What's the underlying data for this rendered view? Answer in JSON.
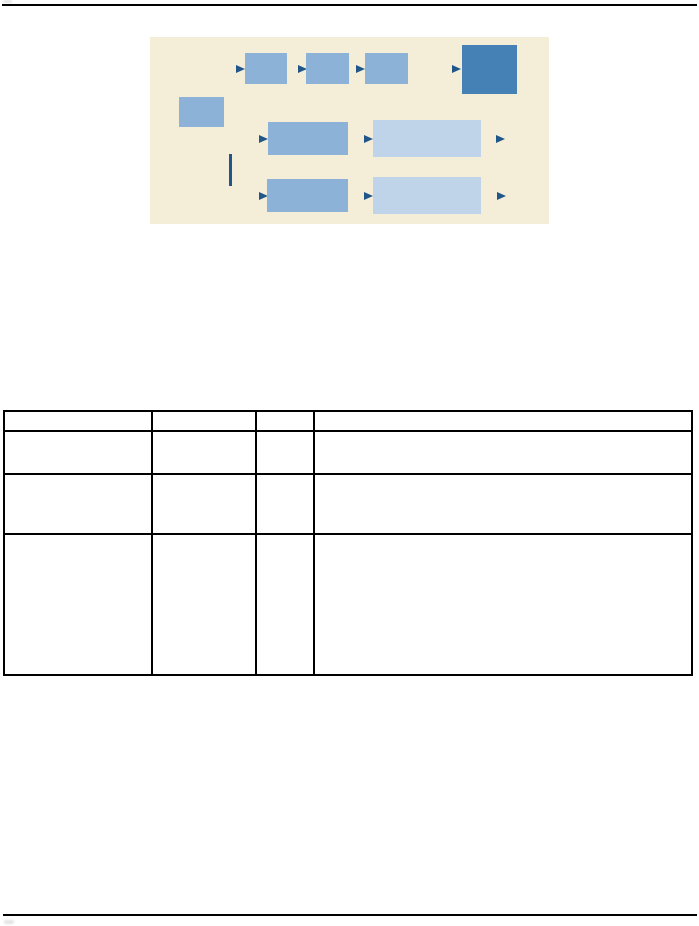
{
  "page": {
    "background": "#ffffff",
    "rule_color": "#000000"
  },
  "figure": {
    "background": "#f4eed8",
    "colors": {
      "node": "#8cb2d8",
      "node_dark": "#4681b5",
      "node_light": "#bfd3e9",
      "connector": "#20568a"
    },
    "nodes": [
      {
        "name": "flow-arrow-1",
        "type": "arrow",
        "x": 86,
        "y": 28
      },
      {
        "name": "flow-box-step1",
        "type": "box",
        "x": 95,
        "y": 16,
        "w": 42,
        "h": 31
      },
      {
        "name": "flow-arrow-2",
        "type": "arrow",
        "x": 148,
        "y": 28
      },
      {
        "name": "flow-box-step2",
        "type": "box",
        "x": 156,
        "y": 16,
        "w": 43,
        "h": 31
      },
      {
        "name": "flow-arrow-3",
        "type": "arrow",
        "x": 206,
        "y": 28
      },
      {
        "name": "flow-box-step3",
        "type": "box",
        "x": 215,
        "y": 16,
        "w": 43,
        "h": 31
      },
      {
        "name": "flow-arrow-4",
        "type": "arrow",
        "x": 302,
        "y": 28
      },
      {
        "name": "flow-box-result",
        "type": "box-dark",
        "x": 312,
        "y": 8,
        "w": 55,
        "h": 49
      },
      {
        "name": "flow-box-start",
        "type": "box",
        "x": 29,
        "y": 60,
        "w": 45,
        "h": 30
      },
      {
        "name": "flow-arrow-5",
        "type": "arrow",
        "x": 109,
        "y": 98
      },
      {
        "name": "flow-box-mid1",
        "type": "box",
        "x": 118,
        "y": 85,
        "w": 80,
        "h": 33
      },
      {
        "name": "flow-arrow-6",
        "type": "arrow",
        "x": 214,
        "y": 98
      },
      {
        "name": "flow-box-wide1",
        "type": "box-light",
        "x": 223,
        "y": 83,
        "w": 108,
        "h": 37
      },
      {
        "name": "flow-arrow-7",
        "type": "arrow",
        "x": 346,
        "y": 98
      },
      {
        "name": "flow-vline",
        "type": "vline",
        "x": 79,
        "y": 117,
        "w": 3,
        "h": 32
      },
      {
        "name": "flow-arrow-8",
        "type": "arrow",
        "x": 109,
        "y": 155
      },
      {
        "name": "flow-box-mid2",
        "type": "box",
        "x": 117,
        "y": 142,
        "w": 81,
        "h": 33
      },
      {
        "name": "flow-arrow-9",
        "type": "arrow",
        "x": 214,
        "y": 155
      },
      {
        "name": "flow-box-wide2",
        "type": "box-light",
        "x": 223,
        "y": 140,
        "w": 108,
        "h": 37
      },
      {
        "name": "flow-arrow-10",
        "type": "arrow",
        "x": 347,
        "y": 155
      }
    ]
  },
  "table": {
    "border_color": "#000000",
    "columns": [
      "",
      "",
      "",
      ""
    ],
    "rows": [
      [
        "",
        "",
        "",
        ""
      ],
      [
        "",
        "",
        "",
        ""
      ],
      [
        "",
        "",
        "",
        ""
      ]
    ]
  }
}
